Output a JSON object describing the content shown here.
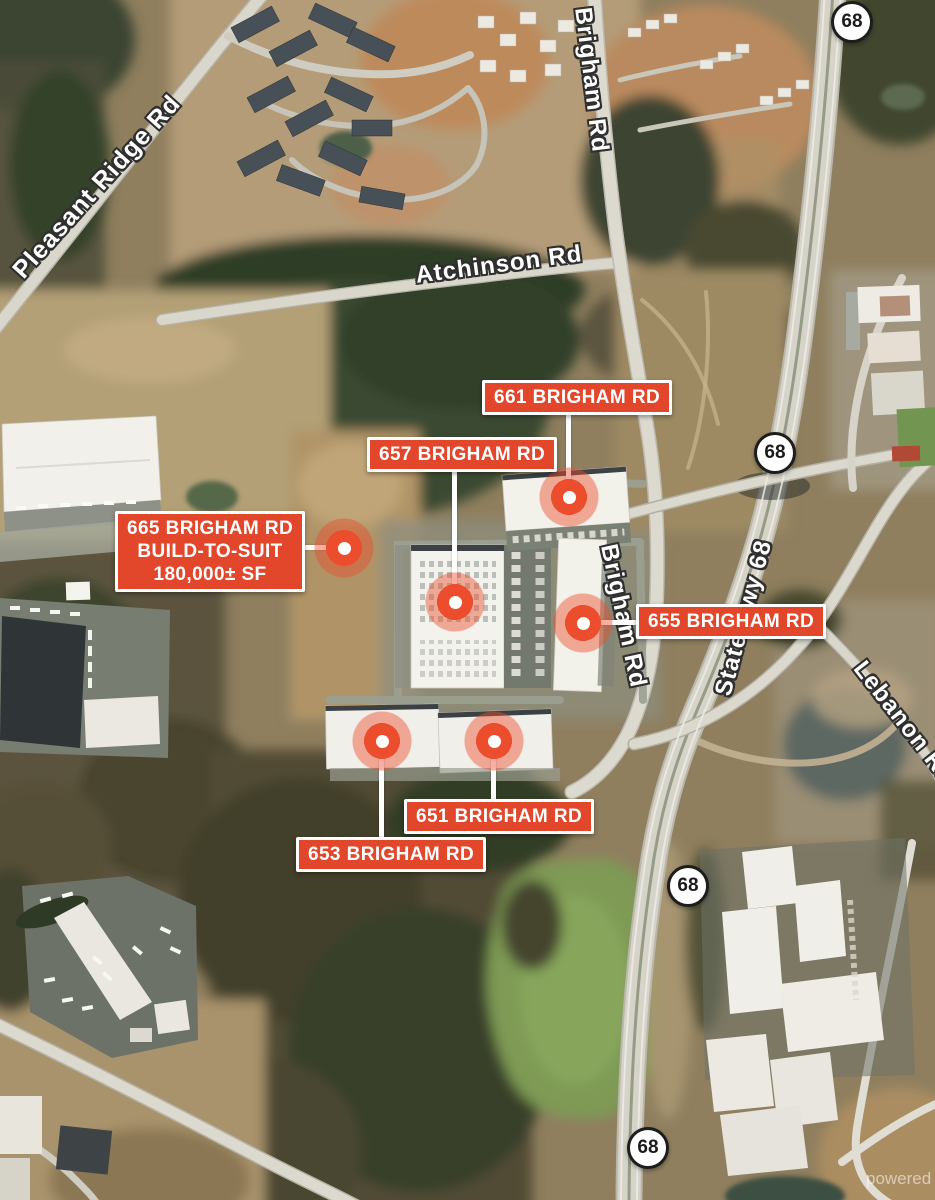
{
  "colors": {
    "label_bg": "#E2472B",
    "label_border": "#FFFFFF",
    "label_text": "#FFFFFF",
    "marker": "#EC4D2C",
    "shield_bg": "#FFFFFF",
    "shield_text": "#1B1B1B",
    "road_text": "#FFFFFF",
    "road_text_outline": "#2F2F2F"
  },
  "road_labels": {
    "pleasant_ridge": "Pleasant Ridge Rd",
    "brigham_north": "Brigham Rd",
    "atchinson": "Atchinson Rd",
    "brigham_mid": "Brigham Rd",
    "state_hwy_68": "State Hwy 68",
    "lebanon": "Lebanon Rd"
  },
  "highway_shield": {
    "route": "68"
  },
  "properties": {
    "p661": {
      "label": "661 BRIGHAM RD"
    },
    "p657": {
      "label": "657 BRIGHAM RD"
    },
    "p665": {
      "label": "665 BRIGHAM RD",
      "line2": "BUILD-TO-SUIT",
      "line3": "180,000± SF"
    },
    "p655": {
      "label": "655 BRIGHAM RD"
    },
    "p651": {
      "label": "651 BRIGHAM RD"
    },
    "p653": {
      "label": "653 BRIGHAM RD"
    }
  },
  "watermark": "powered b"
}
